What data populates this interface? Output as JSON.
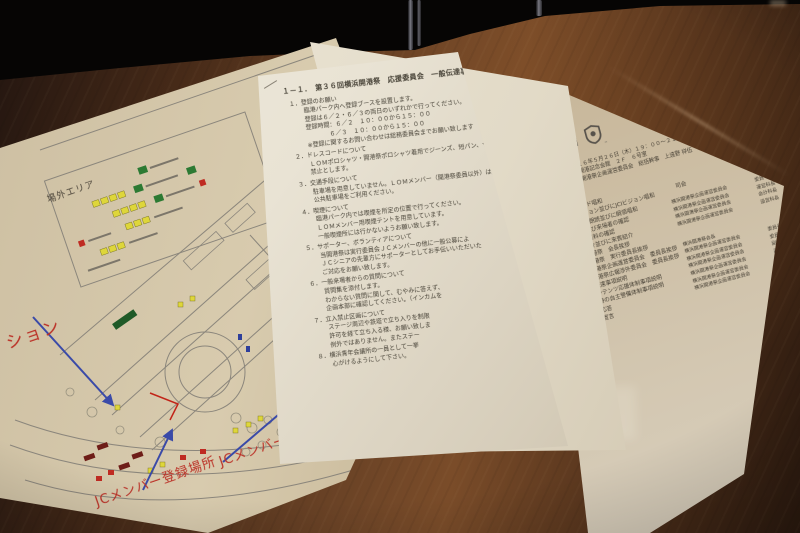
{
  "colors": {
    "wood_mid": "#6b4326",
    "wood_dark": "#2c1a0f",
    "paper_map": "#cdbfa2",
    "paper_white": "#efe9da",
    "paper_agenda": "#c9b99d",
    "annotation_red": "#bb3026",
    "arrow_blue": "#3a4aa8",
    "marker_yellow": "#ded63a",
    "marker_green": "#2c7a33",
    "marker_red": "#bf2b22",
    "route_red": "#c22418",
    "ink": "#433d32"
  },
  "map_doc": {
    "legend_title": "場外エリア",
    "annotations": {
      "station_partial": "ション",
      "register_label": "JCメンバー登録場所",
      "member_label": "JCメンバー"
    }
  },
  "mid_doc": {
    "lines": [
      {
        "c": "h",
        "t": "１－１．　第３６回横浜開港祭　応援委員会　一般伝達事項"
      },
      {
        "c": "n",
        "t": "１．登録のお願い"
      },
      {
        "c": "b",
        "t": "臨港パーク内へ登録ブースを設置します。"
      },
      {
        "c": "b",
        "t": "登録は６／２・６／３の両日のいずれかで行ってください。"
      },
      {
        "c": "b",
        "t": "登録時間：６／２　１０：００から１５：００"
      },
      {
        "c": "b2",
        "t": "６／３　１０：００から１５：００"
      },
      {
        "c": "b",
        "t": "※登録に関するお問い合わせは総務委員会までお願い致します"
      },
      {
        "c": "n",
        "t": "２．ドレスコードについて"
      },
      {
        "c": "b",
        "t": "ＬＯＭポロシャツ・開港祭ポロシャツ着用でジーンズ、短パン、サンダルは"
      },
      {
        "c": "b",
        "t": "禁止とします。"
      },
      {
        "c": "n",
        "t": "３．交通手段について"
      },
      {
        "c": "b",
        "t": "駐車場を用意していません。ＬＯＭメンバー（開港祭委員以外）は近隣の"
      },
      {
        "c": "b",
        "t": "公共駐車場をご利用ください。"
      },
      {
        "c": "n",
        "t": "４．喫煙について"
      },
      {
        "c": "b",
        "t": "臨港パーク内では喫煙を所定の位置で行ってください。"
      },
      {
        "c": "b",
        "t": "ＬＯＭメンバー用喫煙テントを用意しています。"
      },
      {
        "c": "b",
        "t": "一般喫煙所には行かないようお願い致します。"
      },
      {
        "c": "n",
        "t": "５．サポーター、ボランティアについて"
      },
      {
        "c": "b",
        "t": "当開港祭は実行委員会ＪＣメンバーの他に一般公募によ"
      },
      {
        "c": "b",
        "t": "ＪＣシニアの先輩方にサポーターとしてお手伝いいただいた"
      },
      {
        "c": "b",
        "t": "ご対応をお願い致します。"
      },
      {
        "c": "n",
        "t": "６．一般来場者からの質問について"
      },
      {
        "c": "b",
        "t": "質問集を添付します。"
      },
      {
        "c": "b",
        "t": "わからない質問に関して、むやみに答えず、"
      },
      {
        "c": "b",
        "t": "企画本部に確認してください。（インカムを"
      },
      {
        "c": "n",
        "t": "７．立入禁止区画について"
      },
      {
        "c": "b",
        "t": "ステージ周辺や鉄塔で立ち入りを制限"
      },
      {
        "c": "b",
        "t": "許可を経て立ち入る様、お願い致しま"
      },
      {
        "c": "b",
        "t": "例外ではありません。またステー"
      },
      {
        "c": "n",
        "t": "８．横浜青年会議所の一員として一挙"
      },
      {
        "c": "b",
        "t": "心がけるようにして下さい。"
      }
    ]
  },
  "jci_doc": {
    "logo_text": "JCI",
    "logo_tm": "™",
    "title_lines": [
      "２０１７年度　一般社団法人横浜青年会議所",
      "第３６回横浜開港祭",
      "連絡調整会議"
    ],
    "meta": [
      {
        "label": "日時",
        "value": "２０１６年５月２６日（木）１９：００～２１：００"
      },
      {
        "label": "場所",
        "value": "横浜開港記念会館　２Ｆ　６号室"
      },
      {
        "label": "出席",
        "value": "横浜開港祭企画運営委員会　総括幹事　上遠野 祥伍　君"
      }
    ],
    "mc_label": "司会",
    "agenda": [
      {
        "n": "1",
        "t": "開会宣言"
      },
      {
        "n": "2",
        "t": "JCIクリード唱和"
      },
      {
        "n": "3",
        "t": "JCIミッション並びにJCIビジョン唱和"
      },
      {
        "n": "4",
        "t": "JC宣言文朗読並びに綱領唱和"
      },
      {
        "n": "5",
        "t": "出席者及び来場者の確認"
      },
      {
        "n": "6",
        "t": "本日の資料の確認"
      },
      {
        "n": "7",
        "t": "役員紹介並びに来賓紹介"
      },
      {
        "n": "8",
        "t": "横浜開港祭　会長挨拶"
      },
      {
        "n": "9",
        "t": "横浜開港祭　実行委員長挨拶"
      },
      {
        "n": "10",
        "t": "横浜開港祭企画運営委員会　委員長挨拶"
      },
      {
        "n": "11",
        "t": "横浜開港祭広報渉外委員会　委員長挨拶"
      },
      {
        "n": "12",
        "t": "一般伝達事項説明"
      },
      {
        "n": "13",
        "t": "各コンテンツ応援体制事項説明"
      },
      {
        "n": "14",
        "t": "雨天時の自主警備体制事項説明"
      },
      {
        "n": "15",
        "t": "質疑応答"
      },
      {
        "n": "16",
        "t": "閉会宣言"
      }
    ],
    "attendees_a": [
      {
        "org": "横浜開港祭企画運営委員会",
        "role": "委員",
        "name": "小柳 健",
        "hon": "君"
      },
      {
        "org": "横浜開港祭企画運営委員会",
        "role": "運営科長",
        "name": "五十嵐 隆行",
        "hon": "君"
      },
      {
        "org": "横浜開港祭企画運営委員会",
        "role": "会計科長",
        "name": "中澤 勇太",
        "hon": "君"
      },
      {
        "org": "横浜開港祭企画運営委員会",
        "role": "設営科長",
        "name": "山田 哲夫",
        "hon": "君"
      }
    ],
    "attendees_b": [
      {
        "org": "横浜開港祭会長",
        "role": "",
        "name": "",
        "hon": ""
      },
      {
        "org": "横浜開港祭企画運営委員会",
        "role": "委員長",
        "name": "野台 賢",
        "hon": "君"
      },
      {
        "org": "横浜開港祭企画運営委員会",
        "role": "委員長",
        "name": "稲垣 賢",
        "hon": "君"
      },
      {
        "org": "横浜開港祭企画運営委員会",
        "role": "副委員長",
        "name": "古屋 智章",
        "hon": "君"
      },
      {
        "org": "横浜開港祭企画運営委員会",
        "role": "副委員長",
        "name": "保田 一成",
        "hon": "君"
      },
      {
        "org": "横浜開港祭企画運営委員会",
        "role": "副委員長",
        "name": "柳川 誠",
        "hon": "君"
      },
      {
        "org": "横浜開港祭企画運営委員会",
        "role": "副委員長",
        "name": "井村 正広",
        "hon": "君"
      }
    ]
  }
}
